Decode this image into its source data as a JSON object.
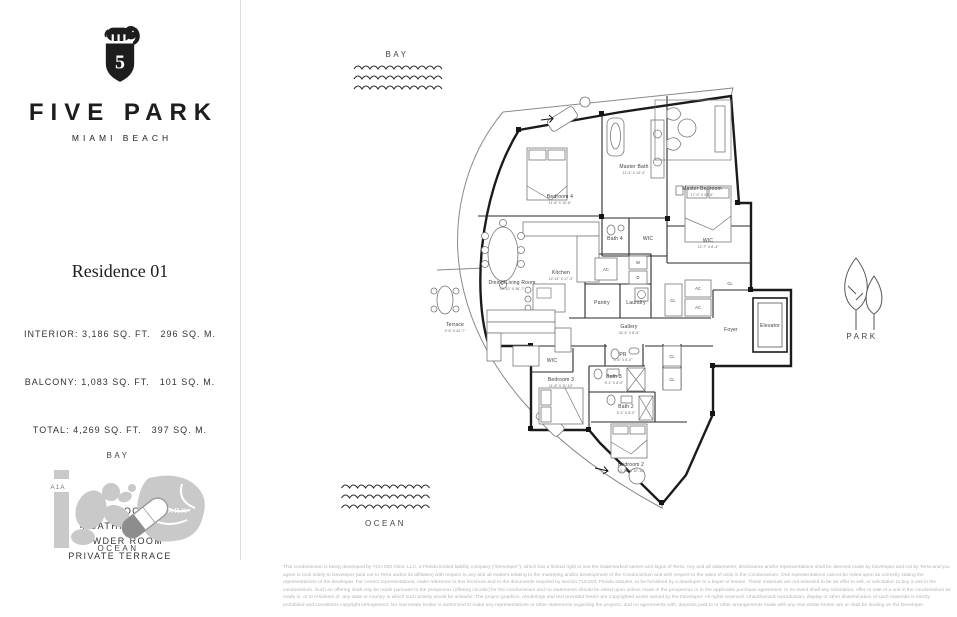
{
  "brand": {
    "name": "FIVE PARK",
    "tagline": "MIAMI BEACH"
  },
  "residence": {
    "title": "Residence 01",
    "stats": [
      "INTERIOR: 3,186 SQ. FT. 296 SQ. M.",
      "BALCONY: 1,083 SQ. FT. 101 SQ. M.",
      "TOTAL: 4,269 SQ. FT. 397 SQ. M."
    ],
    "features": [
      "4 BEDROOMS",
      "4 BATHROOMS",
      "POWDER ROOM",
      "PRIVATE TERRACE"
    ]
  },
  "site_map": {
    "bay": "BAY",
    "road": "A1A",
    "park": "PARK",
    "ocean": "OCEAN"
  },
  "context": {
    "bay": "BAY",
    "ocean": "OCEAN",
    "park": "PARK"
  },
  "plan": {
    "rooms": [
      {
        "name": "Bedroom 4",
        "dims": "11'-8\" X 10'-8\""
      },
      {
        "name": "Master Bath",
        "dims": "11'-4\" X 14'-4\""
      },
      {
        "name": "Master Bedroom",
        "dims": "17'-0\" X 20'-4\""
      },
      {
        "name": "Bath 4",
        "dims": ""
      },
      {
        "name": "WIC",
        "dims": ""
      },
      {
        "name": "WIC",
        "dims": "12'-7\" X 6'-4\""
      },
      {
        "name": "Kitchen",
        "dims": "12'-11\" X 17'-3\""
      },
      {
        "name": "Dining/Living Room",
        "dims": "13'-10\" X 38'-7\""
      },
      {
        "name": "Terrace",
        "dims": "9'-6\" X 42'-7\""
      },
      {
        "name": "Pantry",
        "dims": ""
      },
      {
        "name": "Laundry",
        "dims": ""
      },
      {
        "name": "Gallery",
        "dims": "34'-4\" X 8'-6\""
      },
      {
        "name": "Foyer",
        "dims": ""
      },
      {
        "name": "Elevator",
        "dims": ""
      },
      {
        "name": "PR",
        "dims": "4'-6\" X 8'-0\""
      },
      {
        "name": "Bath 3",
        "dims": "5'-1\" X 8'-0\""
      },
      {
        "name": "Bath 2",
        "dims": "5'-1\" X 8'-0\""
      },
      {
        "name": "Bedroom 3",
        "dims": "11'-8\" X 11'-10\""
      },
      {
        "name": "Bedroom 2",
        "dims": "13'-10\" X 10'-10\""
      },
      {
        "name": "WIC",
        "dims": ""
      }
    ],
    "labels": {
      "w": "W",
      "d": "D",
      "ac": "AC",
      "cl": "CL"
    }
  },
  "disclaimer": "This condominium is being developed by TCH 500 Alton, LLC, a Florida limited liability company (\"Developer\"), which has a limited right to use the trademarked names and logos of Terra. Any and all statements, disclosures and/or representations shall be deemed made by Developer and not by Terra and you agree to look solely to Developer (and not to Terra and/or its affiliates) with respect to any and all matters relating to the marketing and/or development of the Condominium and with respect to the sales of units in the Condominium. Oral representations cannot be relied upon as correctly stating the representations of the developer. For correct representations, make reference to this brochure and to the documents required by section 718.503, Florida statutes, to be furnished by a developer to a buyer or lessee. These materials are not intended to be an offer to sell, or solicitation to buy a unit in the condominium. Such an offering shall only be made pursuant to the prospectus (offering circular) for the condominium and no statements should be relied upon unless made in the prospectus or in the applicable purchase agreement. In no event shall any solicitation, offer or sale of a unit in the condominium be made in, or to residents of, any state or country in which such activity would be unlawful. The project graphics, renderings and text provided herein are copyrighted works owned by the Developer. All rights reserved. Unauthorized reproduction, display or other dissemination of such materials is strictly prohibited and constitutes copyright infringement. No real estate broker is authorized to make any representations or other statements regarding the projects, and no agreements with, deposits paid to or other arrangements made with any real estate broker are or shall be binding on the Developer."
}
